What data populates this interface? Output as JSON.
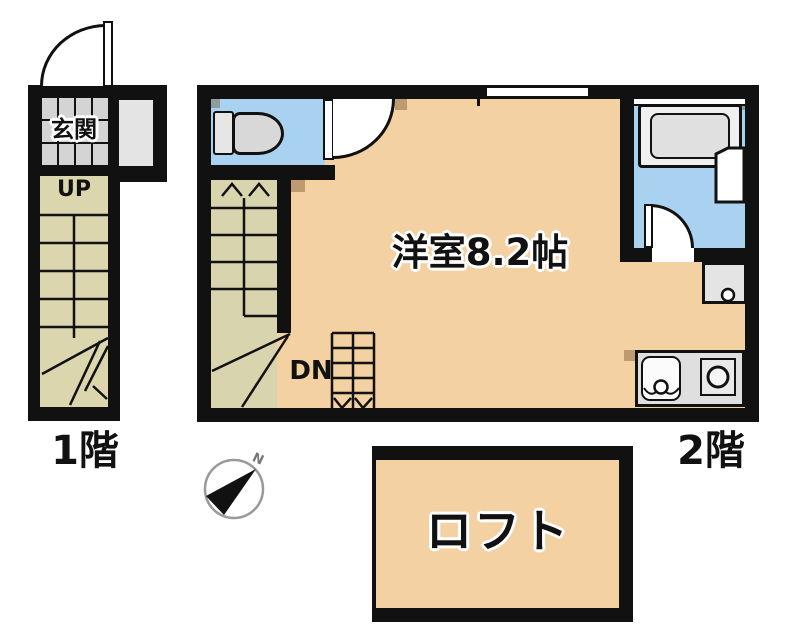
{
  "floor1": {
    "label": "1階",
    "entrance_label": "玄関",
    "stairs_up_label": "UP"
  },
  "floor2": {
    "label": "2階",
    "room_label": "洋室8.2帖",
    "stairs_down_label": "DN"
  },
  "loft": {
    "label": "ロフト"
  },
  "compass": {
    "north_label": "N"
  },
  "colors": {
    "wall": "#111111",
    "room_floor": "#f4d1a3",
    "wet_area_floor": "#a9d2f1",
    "stairs_floor": "#dcd6ae",
    "entrance_tile": "#d4d4d4",
    "kitchen_counter": "#dfdfdf"
  }
}
